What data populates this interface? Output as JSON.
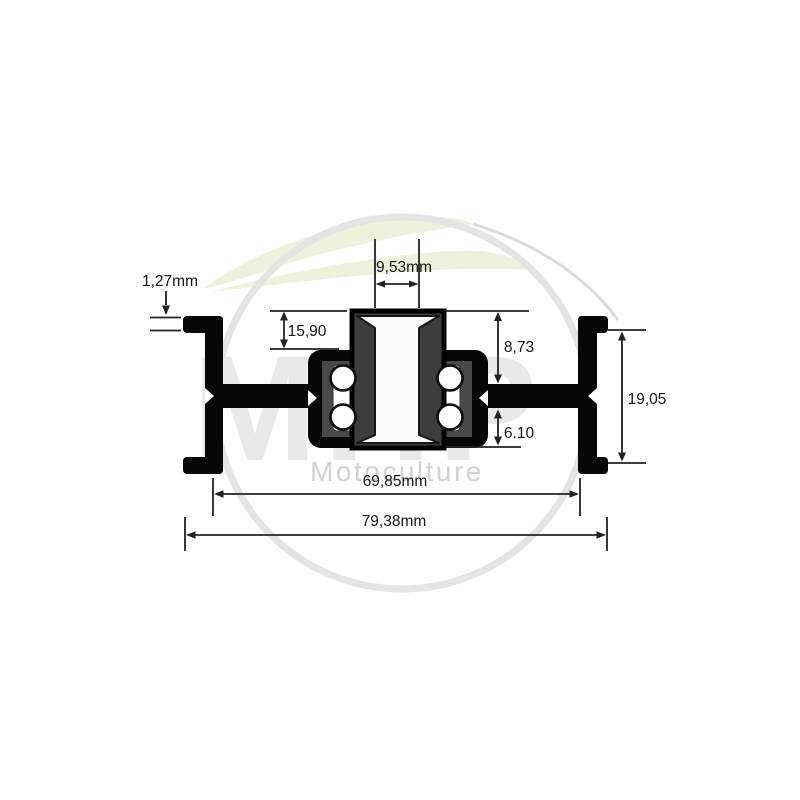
{
  "watermark": {
    "monogram": "MHP",
    "wordmark": "Motoculture"
  },
  "dimensions": {
    "flange_lip_thickness": {
      "label": "1,27mm"
    },
    "hub_protrusion": {
      "label": "15,90"
    },
    "bore_width": {
      "label": "9,53mm"
    },
    "hub_upper_height": {
      "label": "8,73"
    },
    "hub_lower_height": {
      "label": "6.10"
    },
    "flange_height": {
      "label": "19,05"
    },
    "inner_width": {
      "label": "69,85mm"
    },
    "overall_width": {
      "label": "79,38mm"
    }
  },
  "colors": {
    "part_fill": "#060606",
    "hub_gray": "#3d3d3d",
    "race_gray": "#494949",
    "dimension_line": "#222222",
    "leaf_green": "#edf2dc",
    "watermark_gray": "#d2d2d2",
    "ring_gray": "#e4e4e4",
    "monogram_gray": "#e9e9e9",
    "background": "#ffffff"
  }
}
